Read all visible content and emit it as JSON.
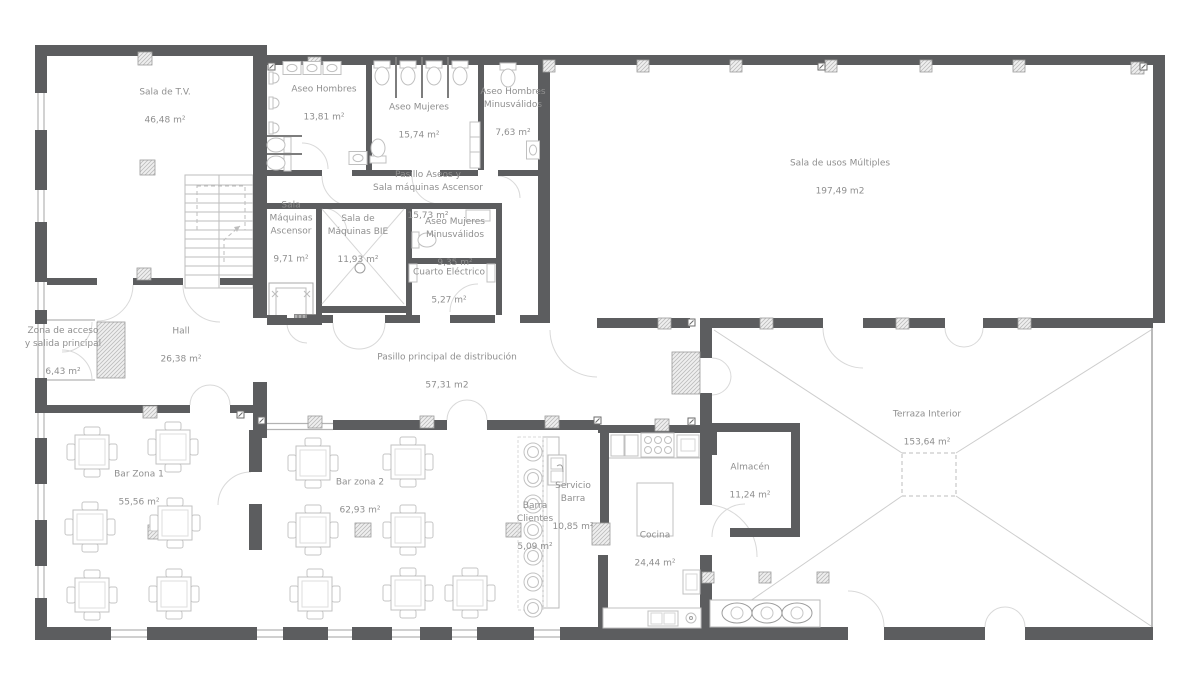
{
  "drawing": {
    "type": "architectural-floor-plan",
    "language": "es",
    "wall_color": "#5c5d5f",
    "line_color": "#c3c3c3",
    "label_color": "#8f8f8f"
  },
  "rooms": [
    {
      "name": "Sala de T.V.",
      "area": "46,48 m²",
      "x": 165,
      "y": 107
    },
    {
      "name": "Aseo Hombres",
      "area": "13,81 m²",
      "x": 324,
      "y": 104
    },
    {
      "name": "Aseo Mujeres",
      "area": "15,74 m²",
      "x": 419,
      "y": 122
    },
    {
      "name": "Aseo Hombres\nMinusválidos",
      "area": "7,63 m²",
      "x": 513,
      "y": 113
    },
    {
      "name": "Pasillo Aseos y\nSala máquinas Ascensor",
      "area": "15,73 m²",
      "x": 428,
      "y": 196
    },
    {
      "name": "Sala\nMáquinas\nAscensor",
      "area": "9,71 m²",
      "x": 291,
      "y": 233
    },
    {
      "name": "Sala de\nMáquinas BIE",
      "area": "11,93 m²",
      "x": 358,
      "y": 240
    },
    {
      "name": "Aseo Mujeres\nMinusválidos",
      "area": "9,35 m²",
      "x": 455,
      "y": 243
    },
    {
      "name": "Cuarto Eléctrico",
      "area": "5,27 m²",
      "x": 449,
      "y": 287
    },
    {
      "name": "Sala de usos Múltiples",
      "area": "197,49 m2",
      "x": 840,
      "y": 178
    },
    {
      "name": "Zona de acceso\ny salida principal",
      "area": "6,43 m²",
      "x": 63,
      "y": 352
    },
    {
      "name": "Hall",
      "area": "26,38 m²",
      "x": 181,
      "y": 346
    },
    {
      "name": "Pasillo principal de distribución",
      "area": "57,31 m2",
      "x": 447,
      "y": 372
    },
    {
      "name": "Bar Zona 1",
      "area": "55,56 m²",
      "x": 139,
      "y": 489
    },
    {
      "name": "Bar zona 2",
      "area": "62,93 m²",
      "x": 360,
      "y": 497
    },
    {
      "name": "Barra\nClientes",
      "area": "5,09 m²",
      "x": 535,
      "y": 527
    },
    {
      "name": "Servicio\nBarra",
      "area": "10,85 m²",
      "x": 573,
      "y": 507
    },
    {
      "name": "Cocina",
      "area": "24,44 m²",
      "x": 655,
      "y": 550
    },
    {
      "name": "Almacén",
      "area": "11,24 m²",
      "x": 750,
      "y": 482
    },
    {
      "name": "Terraza Interior",
      "area": "153,64 m²",
      "x": 927,
      "y": 429
    }
  ]
}
